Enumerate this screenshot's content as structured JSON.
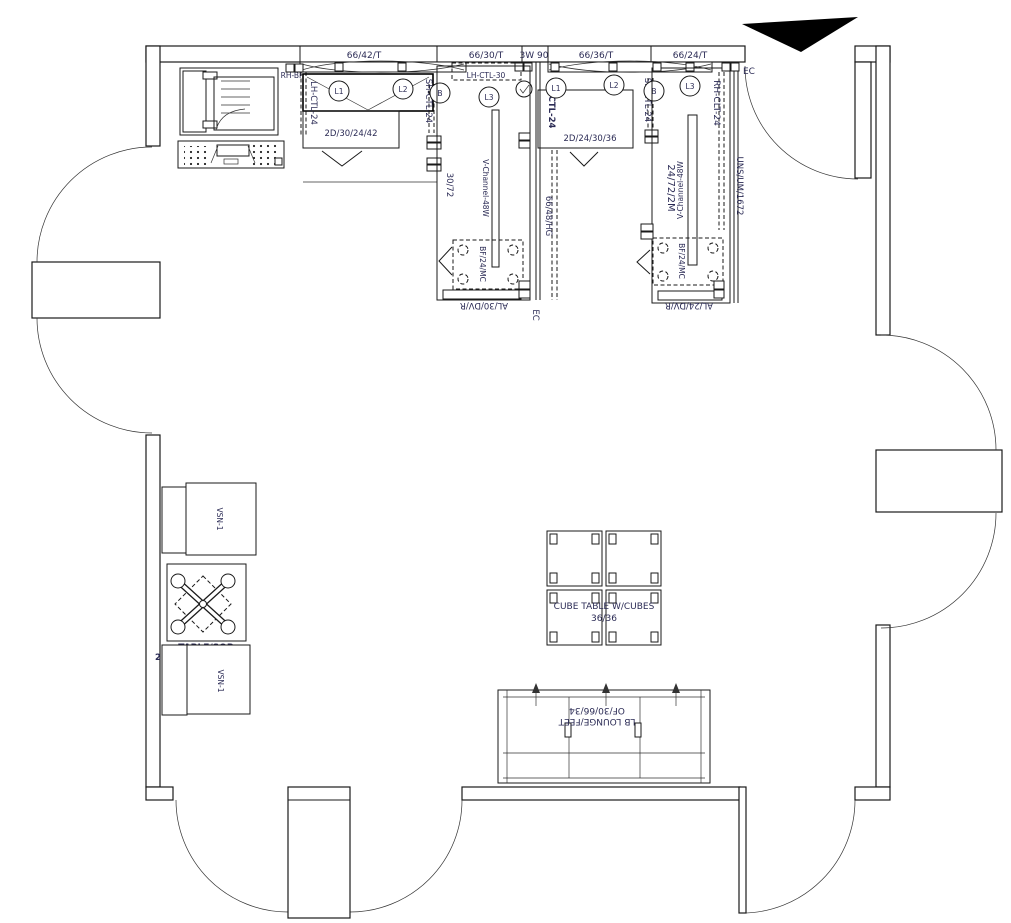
{
  "colors": {
    "line": "#1a1a1a",
    "text": "#2b2b55"
  },
  "top_dimensions": {
    "d1": "66/42/T",
    "d2": "66/30/T",
    "d3": "3W 90",
    "d4": "66/36/T",
    "d5": "66/24/T"
  },
  "labels": {
    "ec_top": "EC",
    "rh_bf": "RH-BF"
  },
  "station1": {
    "panel_left": "LH-CTL-24",
    "panel_right": "SH-CTL-24",
    "cabinet": "2D/30/24/42",
    "light1": "L1",
    "light2": "L2",
    "junction": "B"
  },
  "mid_panel": {
    "label": "LH-CTL-30",
    "light3": "L3"
  },
  "bay1": {
    "size": "30/72",
    "channel": "V-Channel-48W",
    "file": "BF/24/MC",
    "base": "AL/30/DV/R",
    "panel": "66/48/HG",
    "ec": "EC"
  },
  "station2": {
    "panel_left": "LH-CTL-24",
    "panel_right": "SH-CTL-24",
    "cabinet": "2D/24/30/36",
    "light1": "L1",
    "light2": "L2",
    "junction": "B",
    "light3": "L3"
  },
  "bay2": {
    "size": "24/72/2M",
    "channel": "V-Channel-48W",
    "file": "BF/24/MC",
    "base": "AL/24/DV/R",
    "panel_left": "RH-CLT-24",
    "panel_right": "UNS/UM/1672"
  },
  "cube_table": {
    "title": "CUBE TABLE W/CUBES",
    "size": "36/36"
  },
  "lounge": {
    "name": "LB LOUNGE/FEET",
    "size": "OF/30/66/34"
  },
  "left_furniture": {
    "chair_top": "VSN-1",
    "chair_bottom": "VSN-1",
    "table_name": "TABLE/SQR",
    "table_size": "2MM/24/24/16/AX/G"
  }
}
